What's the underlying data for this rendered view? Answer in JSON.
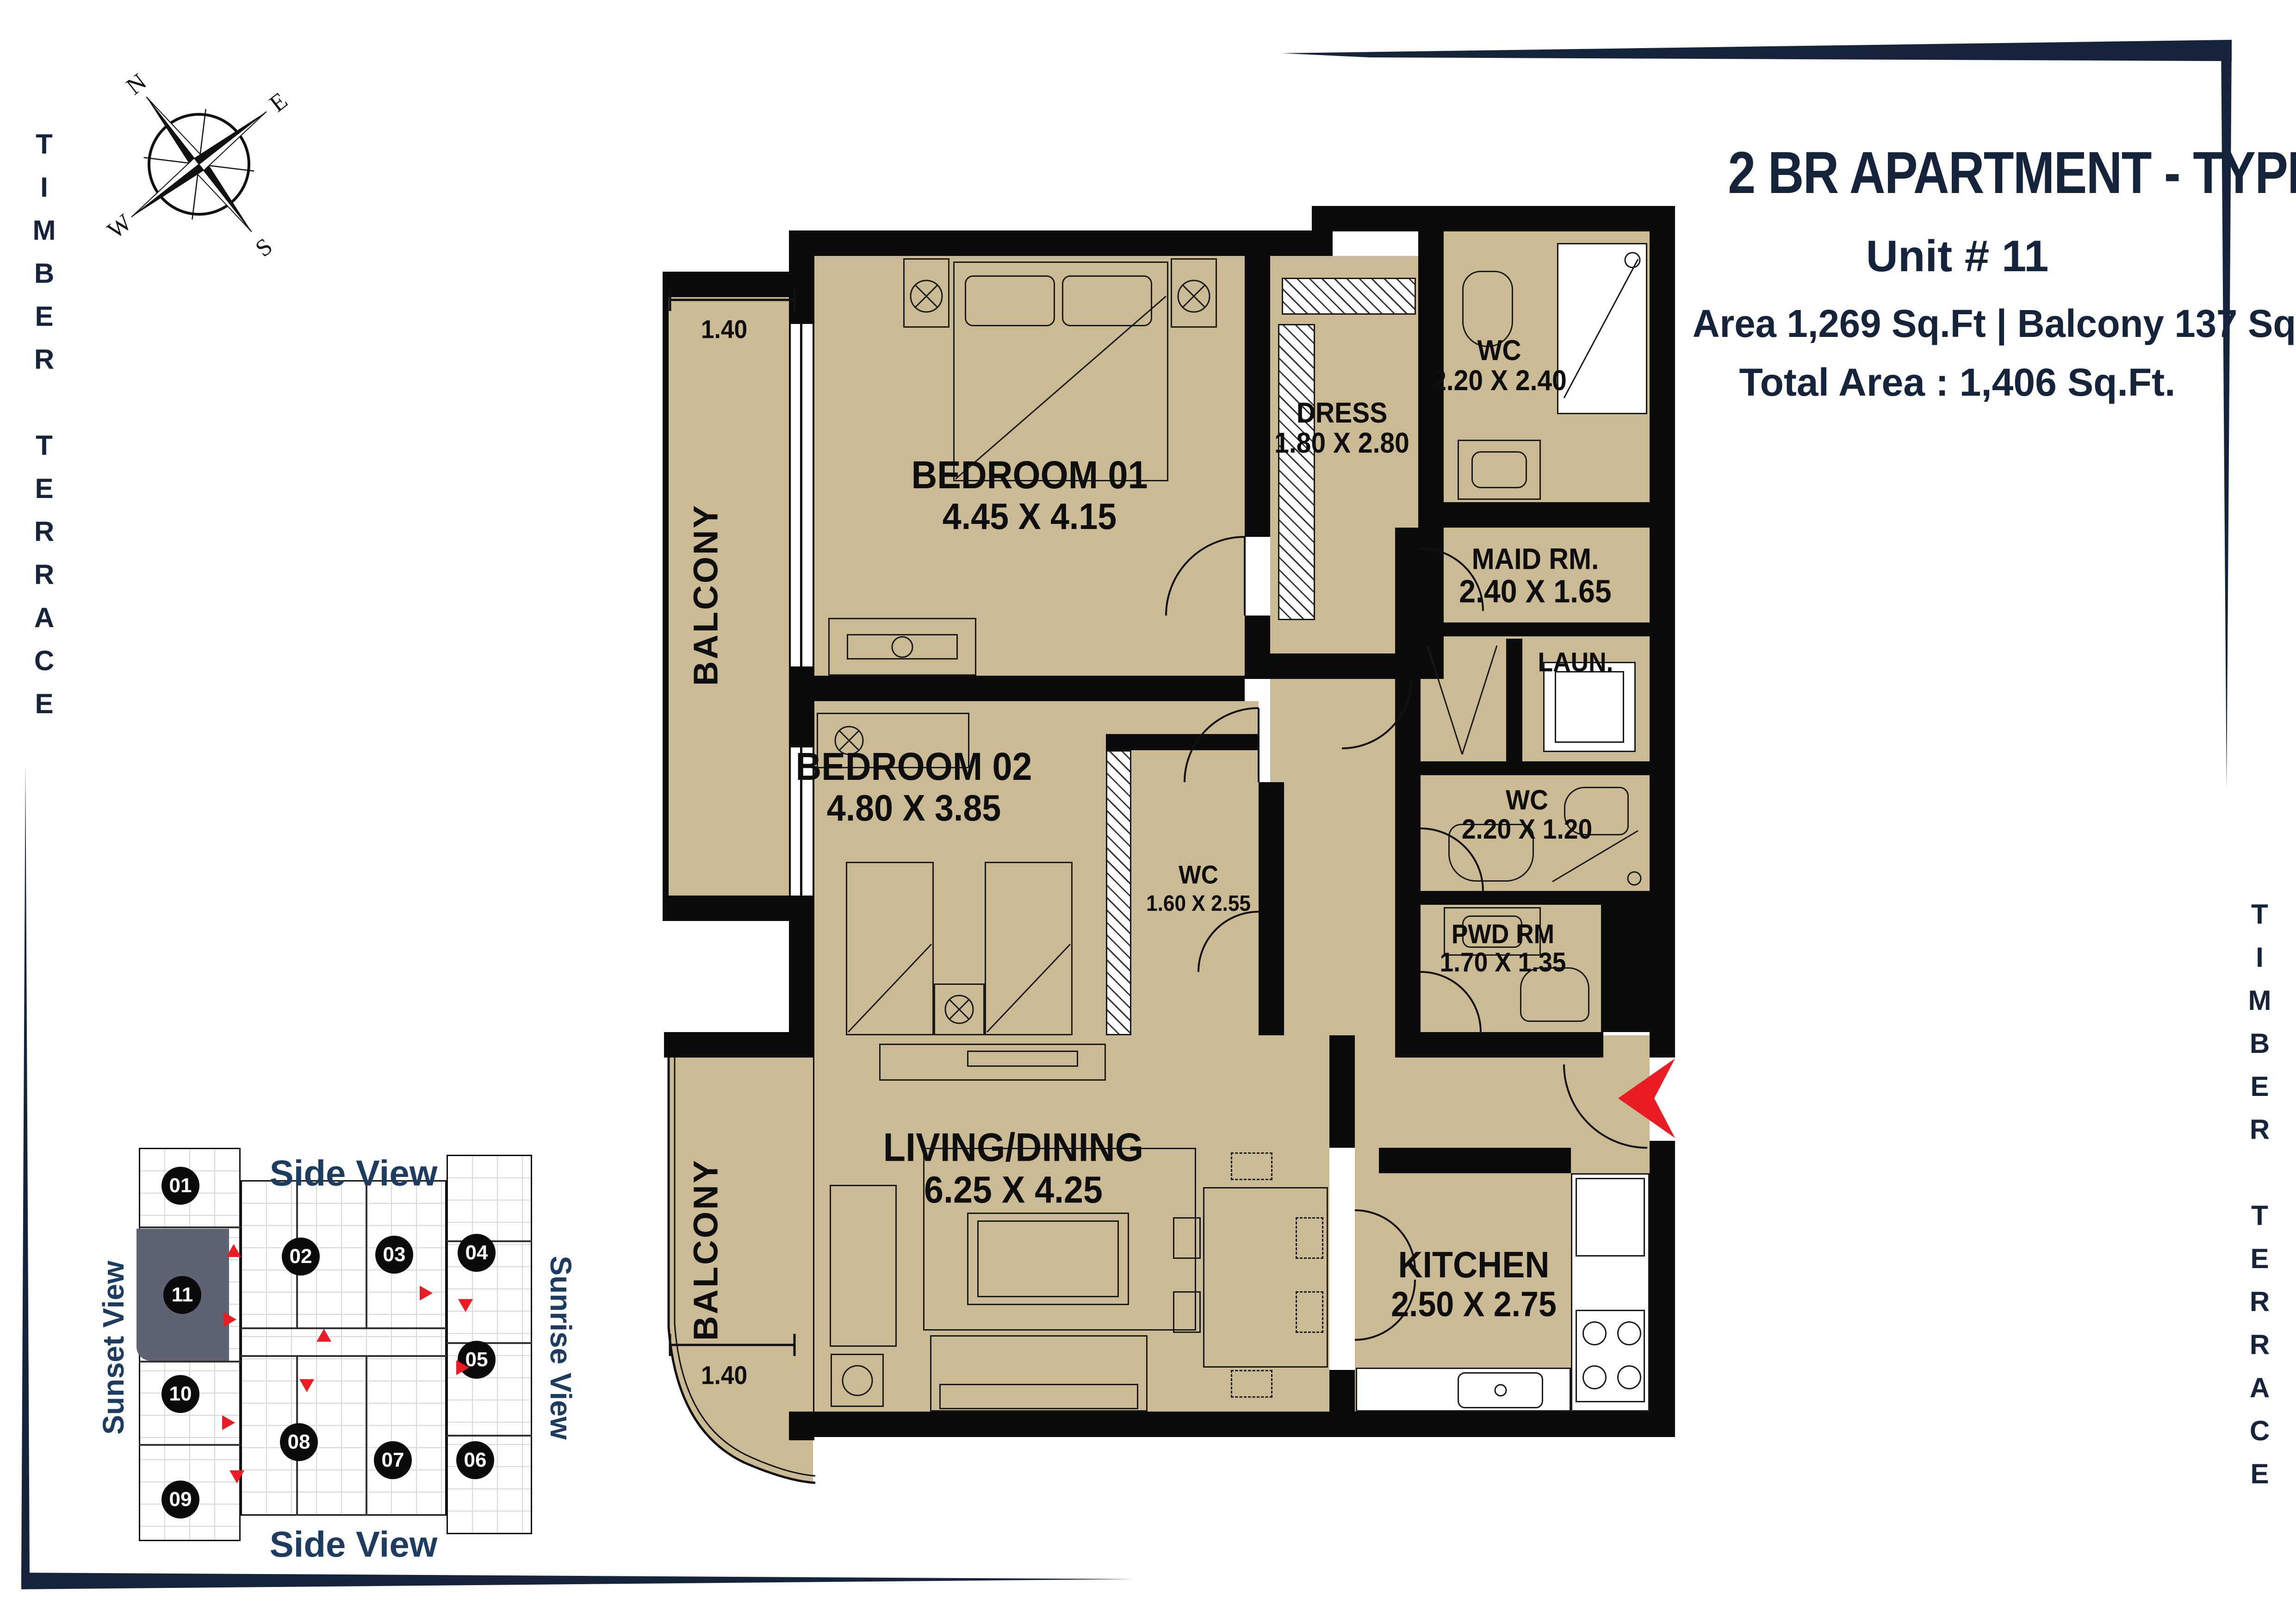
{
  "building": {
    "name_vertical_left": "TIMBER TERRACE",
    "name_vertical_right": "TIMBER TERRACE"
  },
  "compass": {
    "n": "N",
    "e": "E",
    "s": "S",
    "w": "W"
  },
  "title_block": {
    "title": "2 BR APARTMENT - TYPE 3",
    "unit": "Unit # 11",
    "area_line": "Area 1,269 Sq.Ft | Balcony 137 Sq.Ft.",
    "total_line": "Total Area : 1,406 Sq.Ft."
  },
  "rooms": {
    "bedroom1": {
      "name": "BEDROOM 01",
      "dims": "4.45 X 4.15"
    },
    "bedroom2": {
      "name": "BEDROOM 02",
      "dims": "4.80 X 3.85"
    },
    "dress": {
      "name": "DRESS",
      "dims": "1.80 X 2.80"
    },
    "wc_master": {
      "name": "WC",
      "dims": "2.20 X 2.40"
    },
    "maid": {
      "name": "MAID RM.",
      "dims": "2.40 X 1.65"
    },
    "laundry": {
      "name": "LAUN."
    },
    "wc_guest": {
      "name": "WC",
      "dims": "2.20 X 1.20"
    },
    "wc_bedroom2": {
      "name": "WC",
      "dims": "1.60 X 2.55"
    },
    "powder": {
      "name": "PWD RM",
      "dims": "1.70 X 1.35"
    },
    "living": {
      "name": "LIVING/DINING",
      "dims": "6.25 X 4.25"
    },
    "kitchen": {
      "name": "KITCHEN",
      "dims": "2.50 X 2.75"
    },
    "balcony_top": {
      "name": "BALCONY",
      "depth": "1.40"
    },
    "balcony_bottom": {
      "name": "BALCONY",
      "depth": "1.40"
    }
  },
  "keyplan": {
    "side_view_top": "Side View",
    "side_view_bottom": "Side View",
    "sunset_view": "Sunset View",
    "sunrise_view": "Sunrise View",
    "highlighted_unit": "11",
    "units": [
      {
        "id": "01"
      },
      {
        "id": "02"
      },
      {
        "id": "03"
      },
      {
        "id": "04"
      },
      {
        "id": "05"
      },
      {
        "id": "06"
      },
      {
        "id": "07"
      },
      {
        "id": "08"
      },
      {
        "id": "09"
      },
      {
        "id": "10"
      },
      {
        "id": "11"
      }
    ]
  },
  "colors": {
    "floor": "#cbbb94",
    "wall": "#0b0b0b",
    "navy": "#15243b",
    "keyplan_text": "#1d3c5f",
    "red": "#ec1c24",
    "highlight": "#5d6371"
  }
}
